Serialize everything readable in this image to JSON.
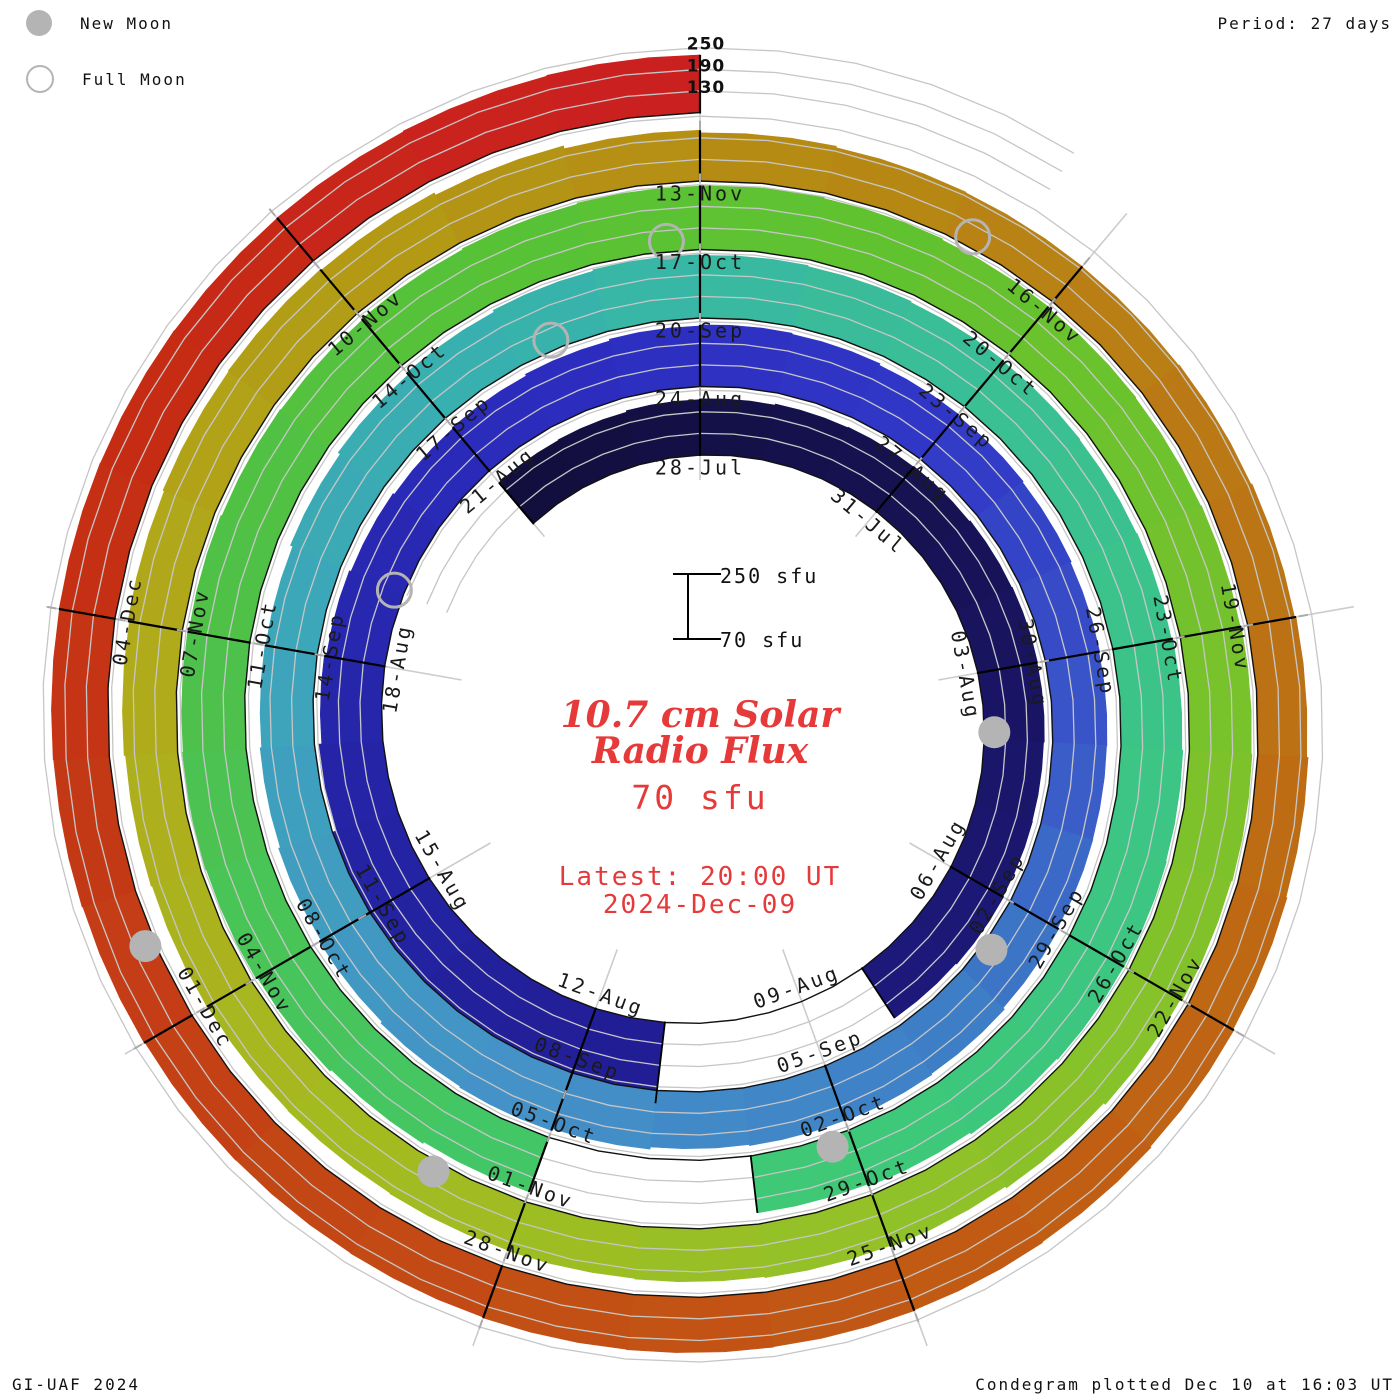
{
  "header": {
    "legend": [
      {
        "icon": "new-moon-icon",
        "label": "New Moon"
      },
      {
        "icon": "full-moon-icon",
        "label": "Full Moon"
      }
    ],
    "period_label": "Period: 27 days"
  },
  "footer": {
    "credit": "GI-UAF 2024",
    "plotted": "Condegram plotted Dec 10 at 16:03 UT"
  },
  "center": {
    "title_line1": "10.7 cm Solar",
    "title_line2": "Radio Flux",
    "latest_value": "70 sfu",
    "latest_line1": "Latest: 20:00 UT",
    "latest_line2": "2024-Dec-09",
    "scale_top_label": "250 sfu",
    "scale_bottom_label": "70 sfu"
  },
  "chart_data": {
    "type": "bar",
    "subtype": "polar-spiral-condegram",
    "title": "10.7 cm Solar Radio Flux",
    "period_days": 27,
    "baseline_sfu": 70,
    "gridline_values_sfu": [
      130,
      190,
      250
    ],
    "outer_scale_labels": [
      "250",
      "190",
      "130"
    ],
    "start_date": "2024-Jul-25",
    "end_date": "2024-Dec-09",
    "daily_flux_sfu": [
      218,
      220,
      224,
      226,
      229,
      231,
      233,
      236,
      238,
      237,
      235,
      236,
      238,
      235,
      null,
      null,
      null,
      296,
      303,
      295,
      282,
      264,
      250,
      240,
      234,
      229,
      225,
      228,
      233,
      238,
      241,
      238,
      233,
      229,
      226,
      223,
      221,
      220,
      221,
      225,
      230,
      233,
      231,
      228,
      234,
      240,
      237,
      232,
      226,
      221,
      217,
      215,
      222,
      229,
      236,
      242,
      246,
      244,
      241,
      238,
      235,
      233,
      235,
      239,
      242,
      244,
      243,
      240,
      235,
      229,
      null,
      null,
      231,
      236,
      241,
      245,
      247,
      245,
      242,
      239,
      237,
      240,
      243,
      246,
      248,
      245,
      242,
      239,
      237,
      239,
      242,
      244,
      241,
      235,
      229,
      224,
      220,
      217,
      215,
      213,
      211,
      210,
      212,
      215,
      219,
      223,
      227,
      229,
      226,
      219,
      211,
      204,
      200,
      198,
      197,
      199,
      202,
      206,
      210,
      213,
      216,
      219,
      221,
      223,
      224,
      223,
      221,
      220,
      221,
      223,
      225,
      226,
      227,
      226,
      225,
      226,
      228,
      230
    ],
    "gap_note": "null = no data plotted (white gap in spiral)",
    "tick_labels": [
      {
        "day": 3,
        "label": "28-Jul"
      },
      {
        "day": 6,
        "label": "31-Jul"
      },
      {
        "day": 9,
        "label": "03-Aug"
      },
      {
        "day": 12,
        "label": "06-Aug"
      },
      {
        "day": 15,
        "label": "09-Aug"
      },
      {
        "day": 18,
        "label": "12-Aug"
      },
      {
        "day": 21,
        "label": "15-Aug"
      },
      {
        "day": 24,
        "label": "18-Aug"
      },
      {
        "day": 27,
        "label": "21-Aug"
      },
      {
        "day": 30,
        "label": "24-Aug"
      },
      {
        "day": 33,
        "label": "27-Aug"
      },
      {
        "day": 36,
        "label": "30-Aug"
      },
      {
        "day": 39,
        "label": "02-Sep"
      },
      {
        "day": 42,
        "label": "05-Sep"
      },
      {
        "day": 45,
        "label": "08-Sep"
      },
      {
        "day": 48,
        "label": "11-Sep"
      },
      {
        "day": 51,
        "label": "14-Sep"
      },
      {
        "day": 54,
        "label": "17-Sep"
      },
      {
        "day": 57,
        "label": "20-Sep"
      },
      {
        "day": 60,
        "label": "23-Sep"
      },
      {
        "day": 63,
        "label": "26-Sep"
      },
      {
        "day": 66,
        "label": "29-Sep"
      },
      {
        "day": 69,
        "label": "02-Oct"
      },
      {
        "day": 72,
        "label": "05-Oct"
      },
      {
        "day": 75,
        "label": "08-Oct"
      },
      {
        "day": 78,
        "label": "11-Oct"
      },
      {
        "day": 81,
        "label": "14-Oct"
      },
      {
        "day": 84,
        "label": "17-Oct"
      },
      {
        "day": 87,
        "label": "20-Oct"
      },
      {
        "day": 90,
        "label": "23-Oct"
      },
      {
        "day": 93,
        "label": "26-Oct"
      },
      {
        "day": 96,
        "label": "29-Oct"
      },
      {
        "day": 99,
        "label": "01-Nov"
      },
      {
        "day": 102,
        "label": "04-Nov"
      },
      {
        "day": 105,
        "label": "07-Nov"
      },
      {
        "day": 108,
        "label": "10-Nov"
      },
      {
        "day": 111,
        "label": "13-Nov"
      },
      {
        "day": 114,
        "label": "16-Nov"
      },
      {
        "day": 117,
        "label": "19-Nov"
      },
      {
        "day": 120,
        "label": "22-Nov"
      },
      {
        "day": 123,
        "label": "25-Nov"
      },
      {
        "day": 126,
        "label": "28-Nov"
      },
      {
        "day": 129,
        "label": "01-Dec"
      },
      {
        "day": 132,
        "label": "04-Dec"
      }
    ],
    "moons": {
      "new_moon_days": [
        9.9,
        39.6,
        69.2,
        99.8,
        129.6
      ],
      "full_moon_days": [
        25.0,
        55.4,
        83.7,
        113.2
      ],
      "new_moon_dates": [
        "2024-Aug-04",
        "2024-Sep-03",
        "2024-Oct-02",
        "2024-Nov-01",
        "2024-Dec-01"
      ],
      "full_moon_dates": [
        "2024-Aug-19",
        "2024-Sep-18",
        "2024-Oct-17",
        "2024-Nov-15"
      ]
    },
    "colors": {
      "moon": "#b4b4b4",
      "gridline": "#c6c6c6",
      "radial_line": "#cccccc",
      "baseline": "#111111",
      "divider": "#000000",
      "tick": "#aaaaaa",
      "label_text": "#1a1a1a",
      "accent_red_text": "#e63939",
      "colormap_stops": [
        [
          0.0,
          "#120e3e"
        ],
        [
          0.045,
          "#171253"
        ],
        [
          0.09,
          "#1c1877"
        ],
        [
          0.125,
          "#211e96"
        ],
        [
          0.16,
          "#2524a6"
        ],
        [
          0.2,
          "#2b2cbe"
        ],
        [
          0.235,
          "#3036c6"
        ],
        [
          0.265,
          "#3a55c8"
        ],
        [
          0.29,
          "#3d7dc6"
        ],
        [
          0.325,
          "#4590c8"
        ],
        [
          0.365,
          "#3da4bc"
        ],
        [
          0.4,
          "#37b2ac"
        ],
        [
          0.425,
          "#3abd9a"
        ],
        [
          0.46,
          "#3cc488"
        ],
        [
          0.5,
          "#3ec878"
        ],
        [
          0.53,
          "#44c763"
        ],
        [
          0.56,
          "#4cc14d"
        ],
        [
          0.595,
          "#57c238"
        ],
        [
          0.625,
          "#63c22e"
        ],
        [
          0.66,
          "#7ac22c"
        ],
        [
          0.7,
          "#93c127"
        ],
        [
          0.73,
          "#a4bb20"
        ],
        [
          0.76,
          "#b0ab1b"
        ],
        [
          0.79,
          "#b39814"
        ],
        [
          0.82,
          "#b78514"
        ],
        [
          0.85,
          "#bb7314"
        ],
        [
          0.88,
          "#c06114"
        ],
        [
          0.91,
          "#c25014"
        ],
        [
          0.94,
          "#c43e16"
        ],
        [
          0.97,
          "#c52c13"
        ],
        [
          1.0,
          "#cb2020"
        ]
      ]
    },
    "layout": {
      "cx": 700,
      "cy": 722,
      "r_base_at_first_label": 267,
      "ring_spacing_px": 68.5,
      "px_per_sfu": 0.36,
      "label_day_of_angle_zero": 3,
      "radial_guide_step_deg": 40,
      "scale_bar": {
        "x": 688,
        "y_top": 574,
        "y_bottom": 639,
        "cap_half_width": 15
      },
      "legend_position": "top-left",
      "grid_on": true
    }
  }
}
